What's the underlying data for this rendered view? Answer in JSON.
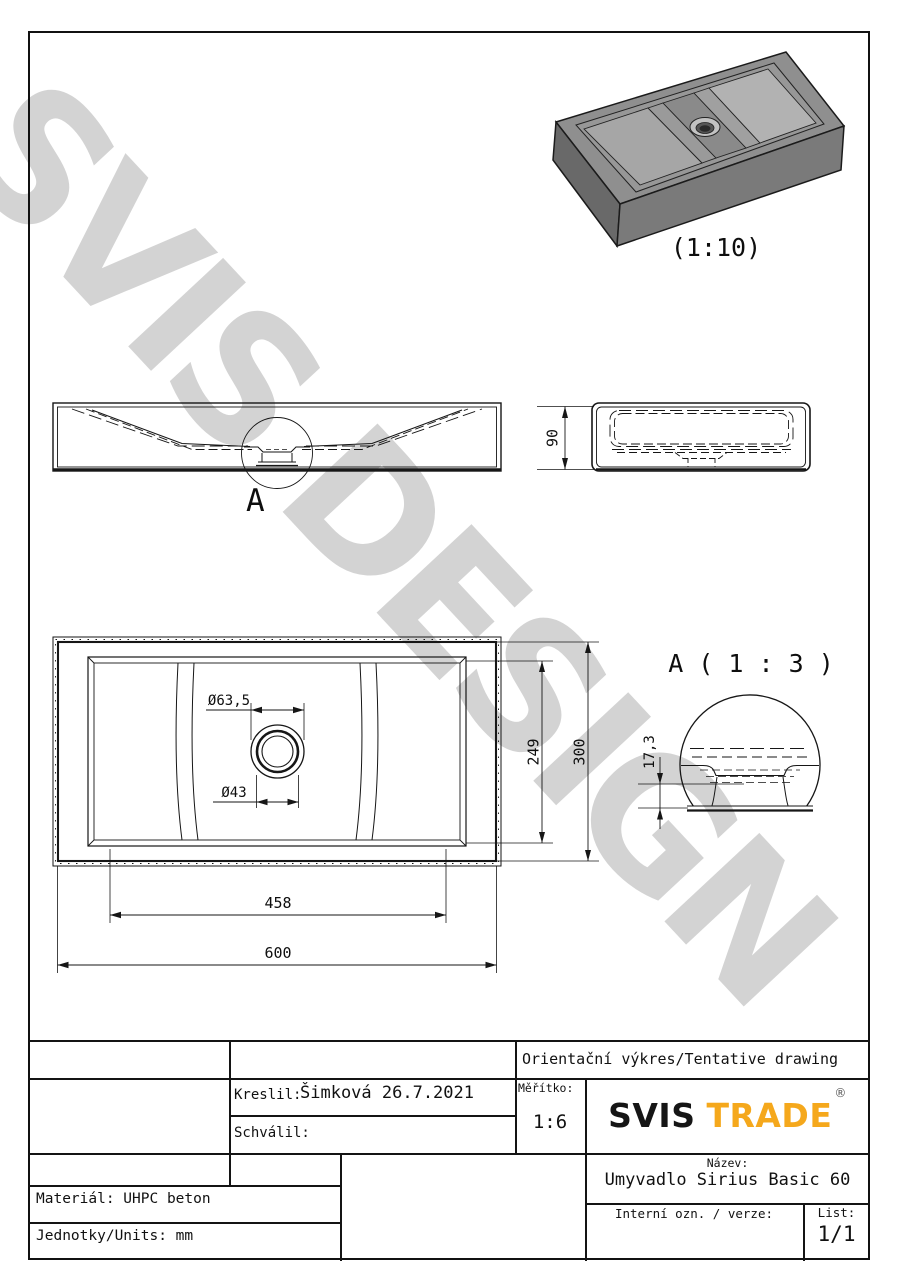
{
  "watermark_text": "SVIS DESIGN",
  "colors": {
    "logo_accent": "#F5A81C",
    "watermark": "#C9C9C9",
    "line": "#141414"
  },
  "views": {
    "isometric": {
      "caption": "(1:10)"
    },
    "front": {
      "detail_marker": "A"
    },
    "side": {
      "dim_height": "90"
    },
    "plan": {
      "dim_drain_outer": "Ø63,5",
      "dim_drain_inner": "Ø43",
      "dim_inner_width": "249",
      "dim_width": "300",
      "dim_inner_length": "458",
      "dim_length": "600"
    },
    "detail_a": {
      "title": "A ( 1 : 3 )",
      "dim_depth": "17,3"
    }
  },
  "title_block": {
    "drawing_type": "Orientační výkres/Tentative drawing",
    "drawn_label": "Kreslil:",
    "drawn_value": "Šimková 26.7.2021",
    "approved_label": "Schválil:",
    "scale_label": "Měřítko:",
    "scale_value": "1:6",
    "logo_primary": "SVIS",
    "logo_secondary": "TRADE",
    "logo_reg": "®",
    "name_label": "Název:",
    "name_value": "Umyvadlo Sirius Basic 60",
    "internal_label": "Interní ozn. / verze:",
    "sheet_label": "List:",
    "sheet_value": "1/1",
    "material": "Materiál: UHPC beton",
    "units": "Jednotky/Units: mm"
  }
}
